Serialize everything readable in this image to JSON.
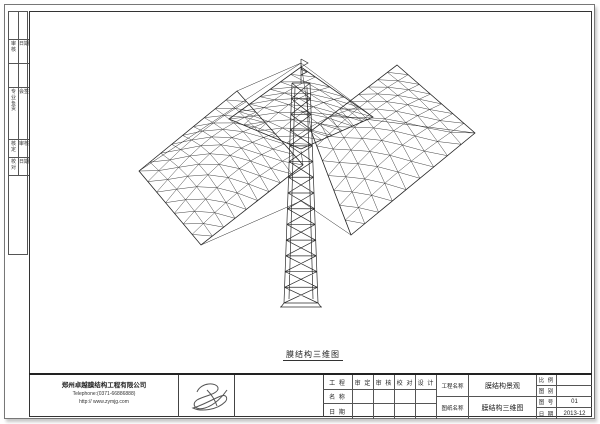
{
  "colors": {
    "line": "#2b2b2b",
    "frame": "#444444",
    "bg": "#ffffff"
  },
  "caption": "膜结构三维图",
  "signoff_strip": {
    "row2": {
      "left": "审核",
      "right": "日期"
    },
    "row4": {
      "left": "专业负责",
      "right": "会签"
    },
    "row5": [
      [
        "核定",
        "审核"
      ],
      [
        "校对",
        "日期"
      ]
    ]
  },
  "company": {
    "name": "郑州卓越膜结构工程有限公司",
    "telephone": "Telephone:(0371-66886888)",
    "website": "http:// www.zymjg.com"
  },
  "title_block": {
    "project_label": "工 程",
    "name_label": "名 称",
    "date_label": "日 期",
    "sign_cols": [
      "审 定",
      "审 核",
      "校 对",
      "设 计"
    ],
    "project_name_label": "工程名称",
    "drawing_name_label": "图纸名称",
    "project_name": "膜结构景观",
    "drawing_name": "膜结构三维图",
    "meta_rows": [
      {
        "label": "比 例",
        "value": ""
      },
      {
        "label": "图 别",
        "value": ""
      },
      {
        "label": "图 号",
        "value": "01"
      },
      {
        "label": "日 期",
        "value": "2013-12"
      }
    ]
  },
  "drawing": {
    "stroke": "#2b2b2b",
    "patches": [
      {
        "corners": [
          [
            138,
            170
          ],
          [
            236,
            90
          ],
          [
            302,
            164
          ],
          [
            200,
            244
          ]
        ],
        "nu": 9,
        "nv": 7,
        "bulge": -14
      },
      {
        "corners": [
          [
            228,
            118
          ],
          [
            300,
            66
          ],
          [
            372,
            116
          ],
          [
            300,
            148
          ]
        ],
        "nu": 7,
        "nv": 5,
        "bulge": -8
      },
      {
        "corners": [
          [
            310,
            130
          ],
          [
            396,
            64
          ],
          [
            474,
            132
          ],
          [
            350,
            234
          ]
        ],
        "nu": 9,
        "nv": 7,
        "bulge": -12
      }
    ],
    "tower": {
      "cx": 300,
      "top": 82,
      "base": 302,
      "half_top": 9,
      "half_base": 17,
      "rungs": 14,
      "mast": 24
    },
    "cables": [
      [
        [
          300,
          62
        ],
        [
          138,
          170
        ]
      ],
      [
        [
          300,
          62
        ],
        [
          236,
          90
        ]
      ],
      [
        [
          300,
          62
        ],
        [
          310,
          130
        ]
      ],
      [
        [
          300,
          62
        ],
        [
          372,
          116
        ]
      ],
      [
        [
          300,
          200
        ],
        [
          200,
          244
        ]
      ],
      [
        [
          300,
          200
        ],
        [
          350,
          234
        ]
      ],
      [
        [
          300,
          150
        ],
        [
          302,
          164
        ]
      ],
      [
        [
          300,
          110
        ],
        [
          474,
          132
        ]
      ]
    ]
  }
}
